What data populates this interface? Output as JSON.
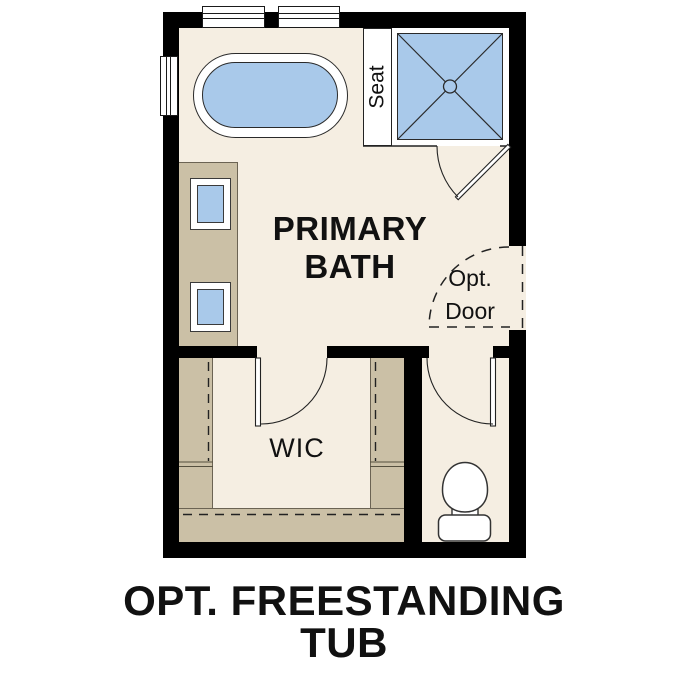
{
  "floorplan": {
    "room_labels": {
      "primary_bath": "PRIMARY BATH",
      "wic": "WIC"
    },
    "annotations": {
      "seat": "Seat",
      "opt_door": "Opt. Door"
    },
    "caption": "OPT. FREESTANDING TUB",
    "fixtures": [
      "freestanding-tub",
      "shower-with-seat",
      "vanity-with-two-sinks",
      "toilet",
      "closet-shelving-with-rods"
    ],
    "doors": [
      "shower-door",
      "optional-door",
      "wic-door",
      "toilet-room-door"
    ]
  },
  "colors": {
    "background": "#ffffff",
    "wall": "#000000",
    "floor": "#f5eee2",
    "cabinetry": "#cbc0a6",
    "water_fixture_fill": "#a9c9ea",
    "linework": "#222222",
    "text": "#111111"
  }
}
